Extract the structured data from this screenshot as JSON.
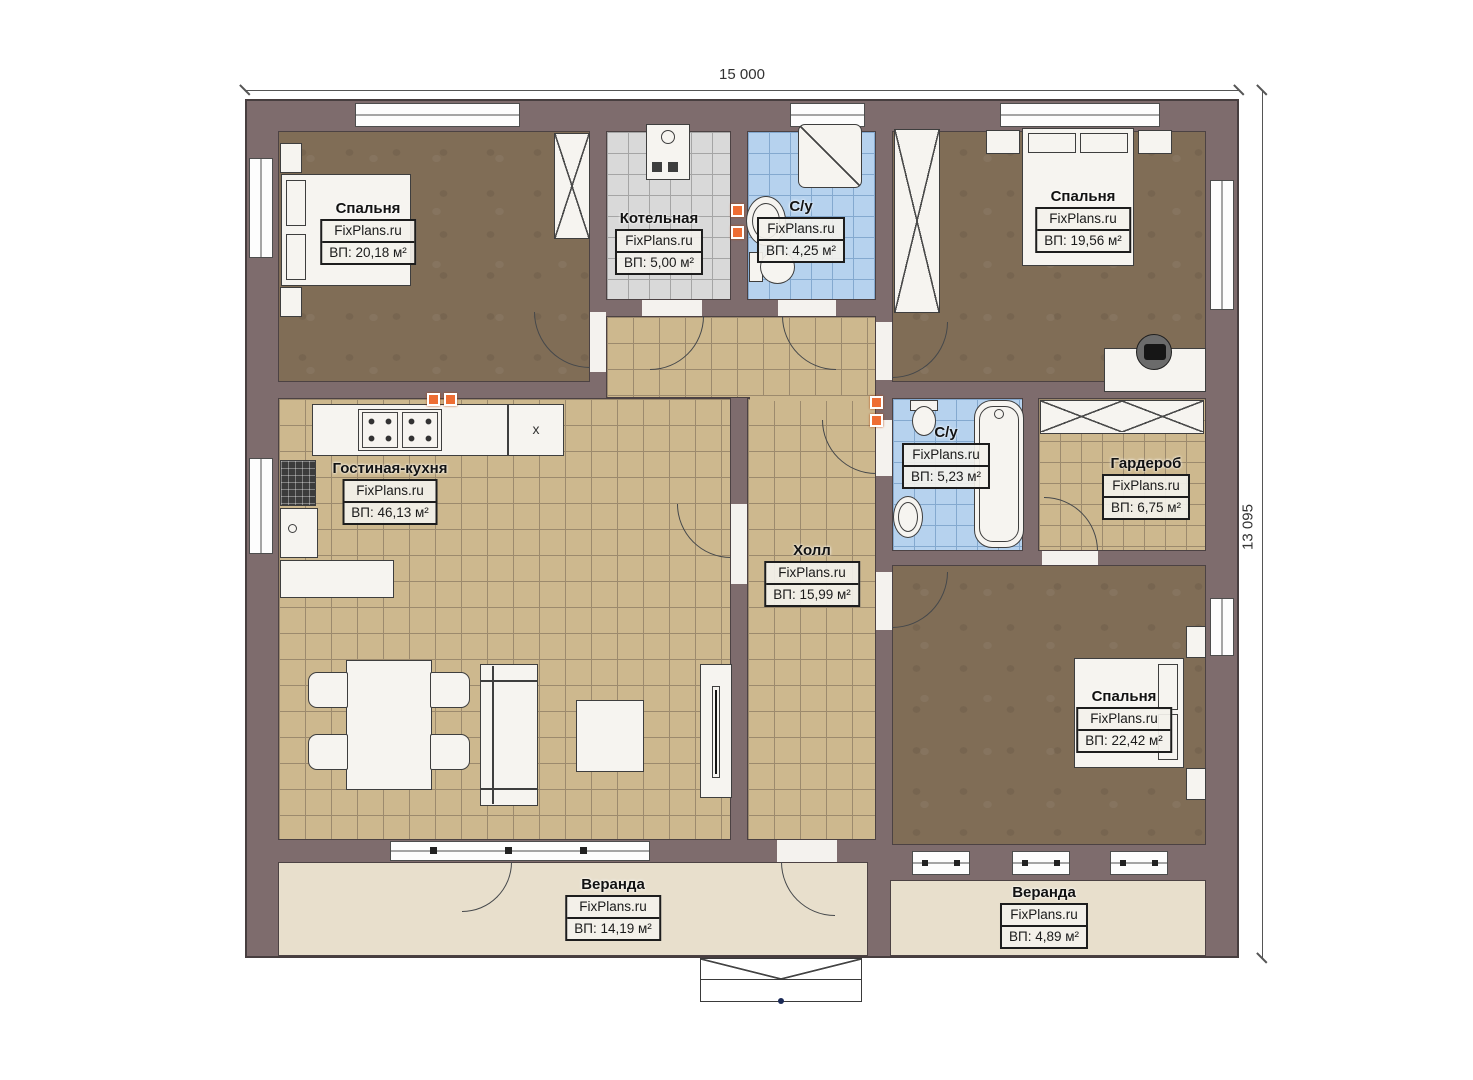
{
  "dimensions": {
    "width": "15 000",
    "height": "13 095"
  },
  "watermark": "FixPlans.ru",
  "rooms": [
    {
      "name": "Спальня",
      "brand": "FixPlans.ru",
      "area": "ВП: 20,18 м²"
    },
    {
      "name": "Котельная",
      "brand": "FixPlans.ru",
      "area": "ВП: 5,00 м²"
    },
    {
      "name": "С/у",
      "brand": "FixPlans.ru",
      "area": "ВП: 4,25 м²"
    },
    {
      "name": "Спальня",
      "brand": "FixPlans.ru",
      "area": "ВП: 19,56 м²"
    },
    {
      "name": "Гостиная-кухня",
      "brand": "FixPlans.ru",
      "area": "ВП: 46,13 м²"
    },
    {
      "name": "Холл",
      "brand": "FixPlans.ru",
      "area": "ВП: 15,99 м²"
    },
    {
      "name": "С/у",
      "brand": "FixPlans.ru",
      "area": "ВП: 5,23 м²"
    },
    {
      "name": "Гардероб",
      "brand": "FixPlans.ru",
      "area": "ВП: 6,75 м²"
    },
    {
      "name": "Спальня",
      "brand": "FixPlans.ru",
      "area": "ВП: 22,42 м²"
    },
    {
      "name": "Веранда",
      "brand": "FixPlans.ru",
      "area": "ВП: 14,19 м²"
    },
    {
      "name": "Веранда",
      "brand": "FixPlans.ru",
      "area": "ВП: 4,89 м²"
    }
  ],
  "marks": {
    "fridge": "x"
  },
  "colors": {
    "wall": "#7e6c6d",
    "bedroom_floor": "#806d56",
    "tile_tan": "#cdb88e",
    "tile_blue": "#b6d2ee",
    "tile_gray": "#d9d9d9",
    "veranda_floor": "#e8dfcc",
    "marker_orange": "#ee6d33"
  }
}
